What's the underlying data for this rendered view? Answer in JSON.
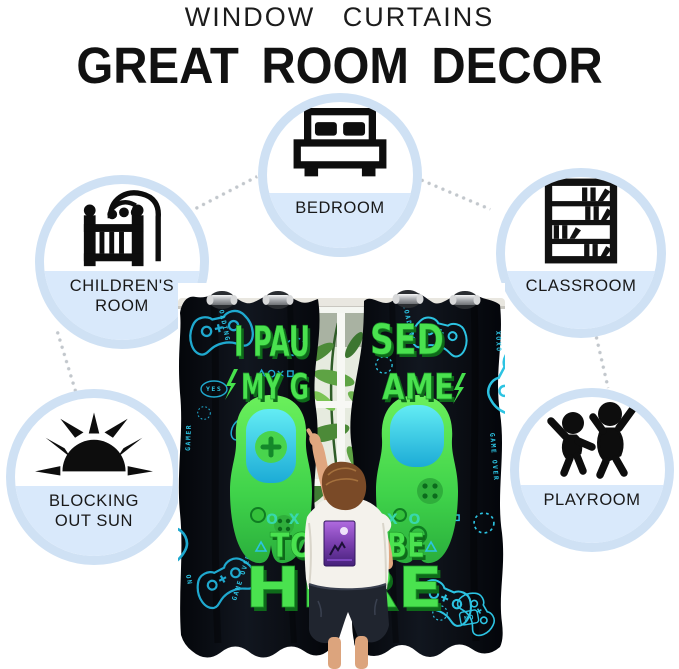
{
  "header": {
    "kicker": "WINDOW CURTAINS",
    "title": "GREAT ROOM DECOR"
  },
  "features": [
    {
      "id": "bedroom",
      "icon": "bed-icon",
      "lines": [
        "BEDROOM"
      ]
    },
    {
      "id": "childrens-room",
      "icon": "crib-icon",
      "lines": [
        "CHILDREN'S",
        "ROOM"
      ]
    },
    {
      "id": "classroom",
      "icon": "bookshelf-icon",
      "lines": [
        "CLASSROOM"
      ]
    },
    {
      "id": "blocking-out-sun",
      "icon": "sun-icon",
      "lines": [
        "BLOCKING",
        "OUT SUN"
      ]
    },
    {
      "id": "playroom",
      "icon": "kids-icon",
      "lines": [
        "PLAYROOM"
      ]
    }
  ],
  "curtain": {
    "slogan": {
      "part1": "I PAU",
      "part2": "SED",
      "part3": "MY G",
      "part4": "AME",
      "part5": "TO",
      "part6": "BE",
      "part7": "HERE"
    },
    "symbols": {
      "left": "O X",
      "right": "— X O"
    },
    "doodles": {
      "loading": "LOADING",
      "gamer": "GAMER",
      "game_over": "GAME OVER",
      "yes": "YES",
      "no": "NO",
      "on": "ON",
      "xoxo": "XOXO"
    }
  },
  "colors": {
    "circle_ring": "#cfe1f4",
    "circle_band": "#d9e9fb",
    "connector_dot": "#c2c7cc",
    "curtain_black": "#0a0d12",
    "doodle_teal": "#1fa9cf",
    "slogan_green": "#4ae24f",
    "controller_green": "#45d34a",
    "controller_cyan": "#36cfe4"
  }
}
